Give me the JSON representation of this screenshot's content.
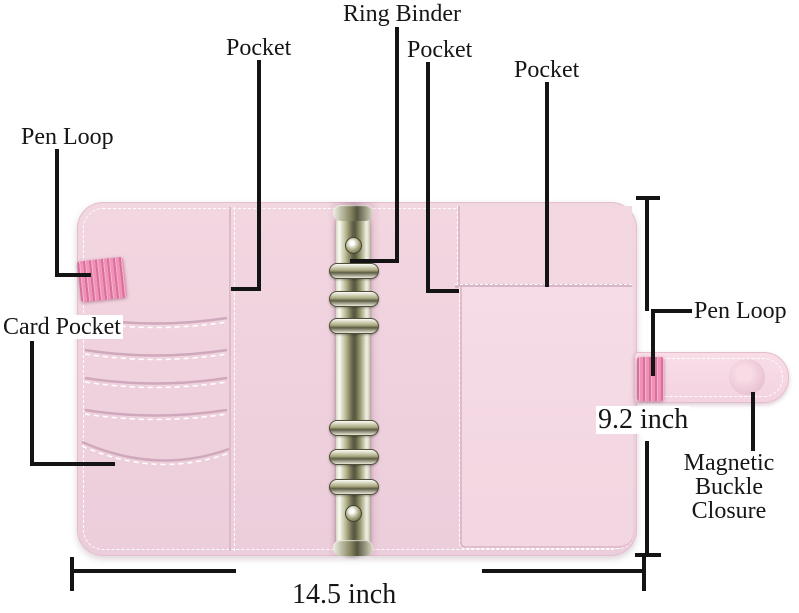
{
  "diagram": {
    "product": "pink leather 6-ring binder planner, opened flat, annotated parts diagram",
    "labels": {
      "pen_loop_left": "Pen Loop",
      "pocket_left": "Pocket",
      "ring_binder": "Ring Binder",
      "pocket_middle": "Pocket",
      "pocket_right": "Pocket",
      "card_pocket": "Card Pocket",
      "pen_loop_right": "Pen Loop",
      "magnetic_buckle_line1": "Magnetic",
      "magnetic_buckle_line2": "Buckle Closure"
    },
    "dimensions": {
      "height": "9.2 inch",
      "width": "14.5 inch"
    },
    "colors": {
      "background": "#ffffff",
      "annotation_line": "#141414",
      "cover_pink": "#efd1dd",
      "pocket_panel_pink": "#f4dbe5",
      "spine_shadow_pink": "#b57a97",
      "pen_loop_pink": "#f291b7",
      "strap_pink": "#f6d9e3",
      "metal_gold": "#6e6e50",
      "stitch_white": "#ffffff"
    }
  }
}
